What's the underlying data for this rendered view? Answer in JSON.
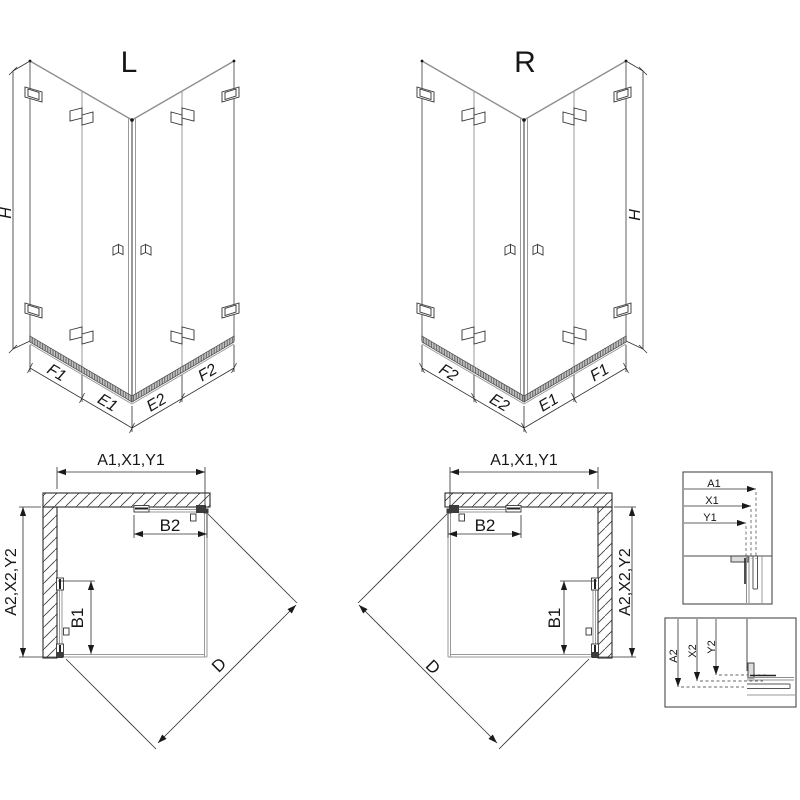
{
  "drawing": {
    "iso_left": {
      "label": "L",
      "height_dim": "H",
      "dim_left_outer": "F1",
      "dim_left_inner": "E1",
      "dim_right_inner": "E2",
      "dim_right_outer": "F2"
    },
    "iso_right": {
      "label": "R",
      "height_dim": "H",
      "dim_left_outer": "F2",
      "dim_left_inner": "E2",
      "dim_right_inner": "E1",
      "dim_right_outer": "F1"
    },
    "plan_left": {
      "width_dim": "A1,X1,Y1",
      "depth_dim": "A2,X2,Y2",
      "door_top_dim": "B2",
      "door_side_dim": "B1",
      "diagonal_dim": "D"
    },
    "plan_right": {
      "width_dim": "A1,X1,Y1",
      "depth_dim": "A2,X2,Y2",
      "door_top_dim": "B2",
      "door_side_dim": "B1",
      "diagonal_dim": "D"
    },
    "detail_width": {
      "dim1": "A1",
      "dim2": "X1",
      "dim3": "Y1"
    },
    "detail_depth": {
      "dim1": "A2",
      "dim2": "X2",
      "dim3": "Y2"
    }
  },
  "colors": {
    "line": "#2e2e2e",
    "glass": "#8f8f8f",
    "text": "#161616",
    "background": "#ffffff"
  }
}
